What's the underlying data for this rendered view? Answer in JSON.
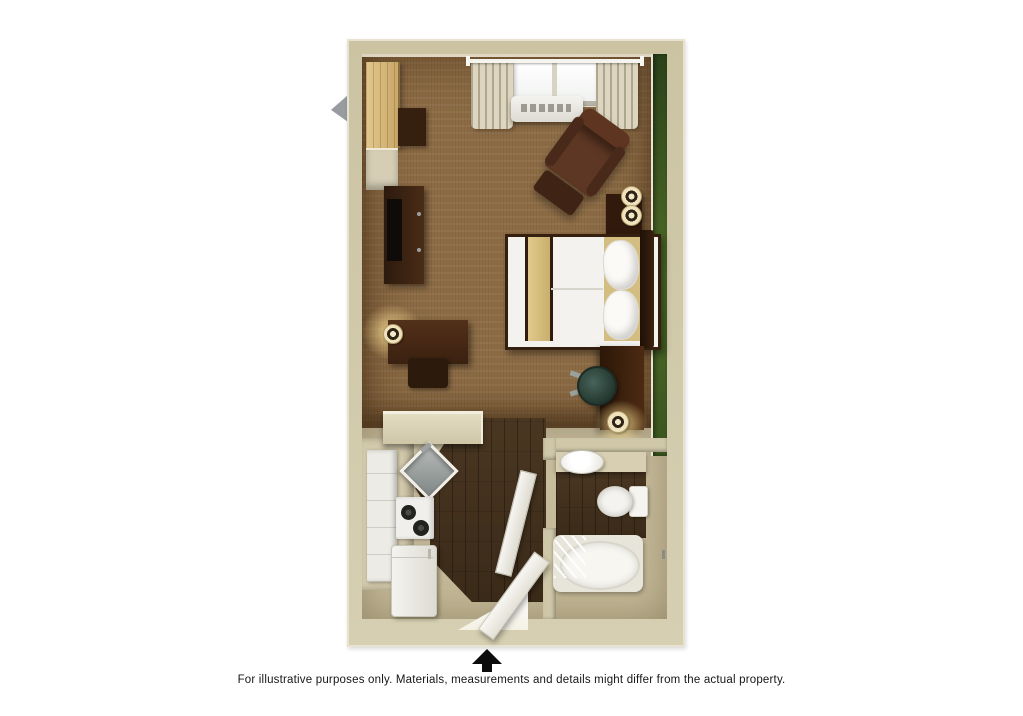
{
  "image_type": "3d-floor-plan-rendering",
  "unit": {
    "type": "studio-guest-room",
    "rooms": [
      {
        "name": "bedroom-living-area",
        "floor": "brown-carpet",
        "accent_wall": "green"
      },
      {
        "name": "kitchen",
        "floor": "dark-wood-vinyl",
        "counters": "tan"
      },
      {
        "name": "bathroom",
        "floor": "dark-wood-vinyl"
      }
    ],
    "furniture": {
      "bedroom": [
        "closet",
        "wardrobe-shelf",
        "side-cabinet",
        "tv-stand-with-television",
        "window-with-curtains",
        "ptac-air-conditioner",
        "armchair-with-ottoman",
        "nightstand",
        "twin-table-lamps",
        "queen-bed-white-bedding-tan-runner",
        "headboard",
        "desk-with-chair-and-lamp",
        "work-table-with-office-chair-and-lamp"
      ],
      "kitchen": [
        "peninsula-counter",
        "corner-sink",
        "two-burner-cooktop",
        "refrigerator",
        "white-cabinets"
      ],
      "bathroom": [
        "vanity-with-sink",
        "toilet",
        "bathtub-with-shower-curtain",
        "bathroom-door"
      ],
      "entry": [
        "entry-door"
      ]
    }
  },
  "palette": {
    "background": "#ffffff",
    "wall": "#cfc7a8",
    "wall_highlight": "#e7e3d0",
    "accent_wall_green": "#41601f",
    "carpet": "#8d6c45",
    "wood_floor": "#46331f",
    "furniture_wood": "#4a2a15",
    "bedding_white": "#f3f2ee",
    "bed_accent_tan": "#d3bd80",
    "fixture_white": "#f4f3ef"
  },
  "compass": {
    "symbol": "north-arrow",
    "points": "up",
    "color": "#0c0c0c"
  },
  "caption": {
    "text": "For illustrative purposes only.  Materials, measurements and details might differ from the actual property."
  }
}
